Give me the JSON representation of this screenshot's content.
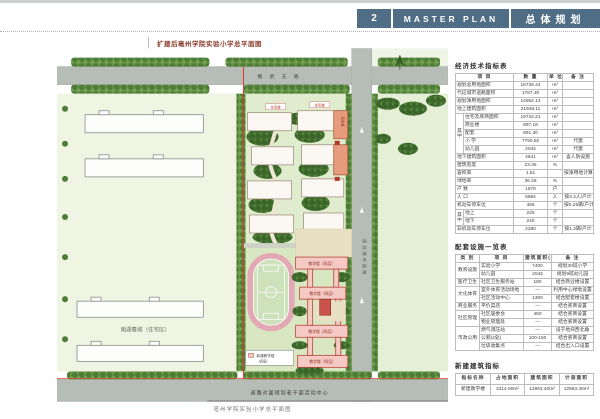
{
  "header": {
    "num": "2",
    "title_en": "MASTER PLAN",
    "title_cn": "总体规划"
  },
  "plan": {
    "title": "扩建后亳州学院实验小学总平面图",
    "caption": "亳州学院实验小学总平面图",
    "road_top": "魏 武 支 路",
    "road_right": "规划城市道路",
    "neighbor_label": "南湖春城（住宅区）",
    "bottom_label": "道路对面规划老干部活动中心",
    "teaching_label": "教学楼（四层）",
    "residential_label": "住宅楼",
    "commercial_label": "商业楼",
    "legend_line1": "新建教学楼",
    "legend_line2": "（四层）",
    "north_label": "N"
  },
  "tables": {
    "eco": {
      "title": "经济技术指标表",
      "group_label": "其中",
      "headers": [
        "项  目",
        "数 量",
        "单 位",
        "备 注"
      ],
      "rows": [
        {
          "item": "规划总用地面积",
          "qty": "16739.44",
          "unit": "m²",
          "note": ""
        },
        {
          "item": "代征城市道路面积",
          "qty": "1787.30",
          "unit": "m²",
          "note": ""
        },
        {
          "item": "规划净用地面积",
          "qty": "14952.14",
          "unit": "m²",
          "note": ""
        },
        {
          "item": "地上建筑面积",
          "qty": "21948.11",
          "unit": "m²",
          "note": ""
        },
        {
          "item": "住宅及底商面积",
          "qty": "19742.21",
          "unit": "m²",
          "note": ""
        },
        {
          "item": "商业楼",
          "qty": "897.19",
          "unit": "m²",
          "note": ""
        },
        {
          "item": "配套",
          "qty": "891.30",
          "unit": "m²",
          "note": ""
        },
        {
          "item": "小  学",
          "qty": "7790.92",
          "unit": "m²",
          "note": "代建"
        },
        {
          "item": "幼儿园",
          "qty": "2042",
          "unit": "m²",
          "note": "代建"
        },
        {
          "item": "地下建筑面积",
          "qty": "4641",
          "unit": "m²",
          "note": "含人防设施"
        },
        {
          "item": "建筑密度",
          "qty": "23.35",
          "unit": "%",
          "note": ""
        },
        {
          "item": "容积率",
          "qty": "1.51",
          "unit": "",
          "note": "按净用地计算"
        },
        {
          "item": "绿地率",
          "qty": "36.28",
          "unit": "%",
          "note": ""
        },
        {
          "item": "户  数",
          "qty": "1870",
          "unit": "户",
          "note": ""
        },
        {
          "item": "人  口",
          "qty": "5984",
          "unit": "人",
          "note": "按3.2人/户计"
        },
        {
          "item": "机动车停车位",
          "qty": "465",
          "unit": "个",
          "note": "按0.25辆/户计"
        },
        {
          "item": "地上",
          "qty": "225",
          "unit": "个",
          "note": ""
        },
        {
          "item": "地下",
          "qty": "240",
          "unit": "个",
          "note": ""
        },
        {
          "item": "非机动车停车位",
          "qty": "2280",
          "unit": "个",
          "note": "按1.2辆/户计"
        }
      ]
    },
    "facilities": {
      "title": "配套设施一览表",
      "headers": [
        "类 别",
        "项 目",
        "建筑面积(m²)",
        "备 注"
      ],
      "groups": [
        {
          "name": "教育设施",
          "rows": [
            [
              "实验小学",
              "7400",
              "规划30班小学"
            ],
            [
              "幼儿园",
              "2042",
              "规划9班幼儿园"
            ]
          ]
        },
        {
          "name": "医疗卫生",
          "rows": [
            [
              "社区卫生服务站",
              "180",
              "结合商业楼设置"
            ]
          ]
        },
        {
          "name": "文化体育",
          "rows": [
            [
              "室外体育活动场地",
              "—",
              "利用中心绿地设置"
            ],
            [
              "社区活动中心",
              "1300",
              "结合配套楼设置"
            ]
          ]
        },
        {
          "name": "商业服务",
          "rows": [
            [
              "平价菜店",
              "—",
              "结合底商设置"
            ]
          ]
        },
        {
          "name": "社区管理",
          "rows": [
            [
              "社区居委会",
              "450",
              "结合底商设置"
            ],
            [
              "物业管理处",
              "—",
              "结合底商设置"
            ]
          ]
        },
        {
          "name": "市政公用",
          "rows": [
            [
              "燃气调压站",
              "—",
              "设于地块西北角"
            ],
            [
              "公厕(2处)",
              "100-150",
              "结合底商设置"
            ],
            [
              "垃圾收集点",
              "—",
              "结合出入口设置"
            ]
          ]
        }
      ]
    },
    "newbuild": {
      "title": "新建建筑指标",
      "headers": [
        "指标名称",
        "占地面积",
        "建筑面积",
        "计容面积"
      ],
      "rows": [
        [
          "新建教学楼",
          "3214.90m²",
          "12963.40m²",
          "12963.40m²"
        ]
      ]
    }
  },
  "colors": {
    "header_bg": "#4f6e85",
    "boundary_red": "#e03a2f",
    "track_pink": "#e2a9b4",
    "school_pink": "#f5c9c4",
    "road_gray": "#b6bcb6"
  }
}
